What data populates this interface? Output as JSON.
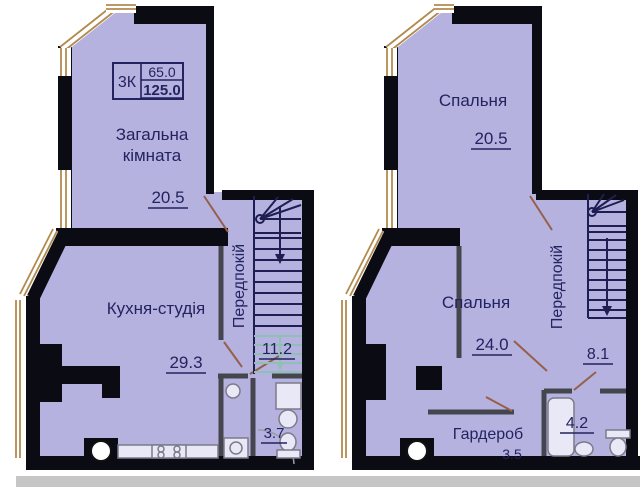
{
  "colors": {
    "floor_fill": "#b5b2e0",
    "wall": "#0b0b13",
    "label_text": "#23235f",
    "window_frame": "#b28a4e",
    "door_leaf": "#95604a",
    "stair_dark": "#1e1e52",
    "stair_light": "#8fc0b4",
    "thin_wall": "#45454e",
    "fixture_line": "#7b7b8a",
    "shadow_strip": "#c6c6c6"
  },
  "info_box": {
    "rooms": "3К",
    "living_area": "65.0",
    "total_area": "125.0"
  },
  "level1": {
    "living_room": {
      "name_line1": "Загальна",
      "name_line2": "кімната",
      "area": "20.5"
    },
    "kitchen": {
      "name": "Кухня-студія",
      "area": "29.3"
    },
    "hallway": {
      "name": "Передпокій",
      "area": "11.2"
    },
    "bathroom": {
      "area": "3.7"
    }
  },
  "level2": {
    "bedroom_top": {
      "name": "Спальня",
      "area": "20.5"
    },
    "bedroom_main": {
      "name": "Спальня",
      "area": "24.0"
    },
    "hallway": {
      "name": "Передпокій",
      "area": "8.1"
    },
    "wardrobe": {
      "name": "Гардероб",
      "area": "3.5"
    },
    "bathroom": {
      "area": "4.2"
    }
  }
}
